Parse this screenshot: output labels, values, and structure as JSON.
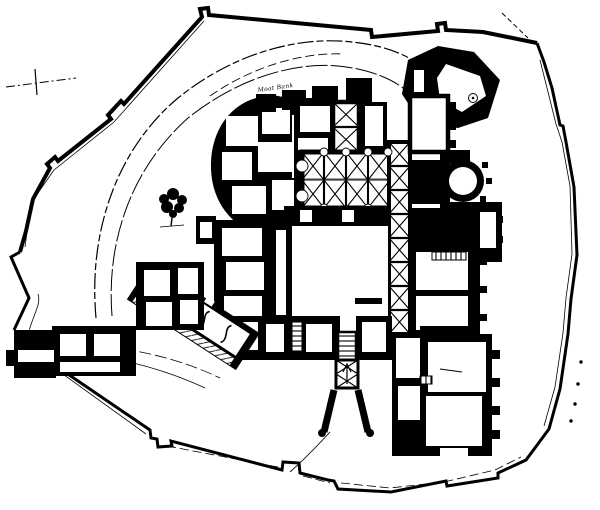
{
  "canvas": {
    "width": 600,
    "height": 510,
    "paper_color": "#ffffff",
    "ink_color": "#000000"
  },
  "plan": {
    "annotation_label": "Moat Bank",
    "vaulted_hall": {
      "bay_columns": 4,
      "bay_rows": 2
    },
    "north_arm_bays": 2,
    "east_gallery_bays": 8,
    "boundary_dot_marks": 4
  },
  "icons": {
    "tree": "deciduous-tree",
    "survey_mark": "plus-cross-benchmark",
    "stair_arrow": "up-arrow"
  }
}
